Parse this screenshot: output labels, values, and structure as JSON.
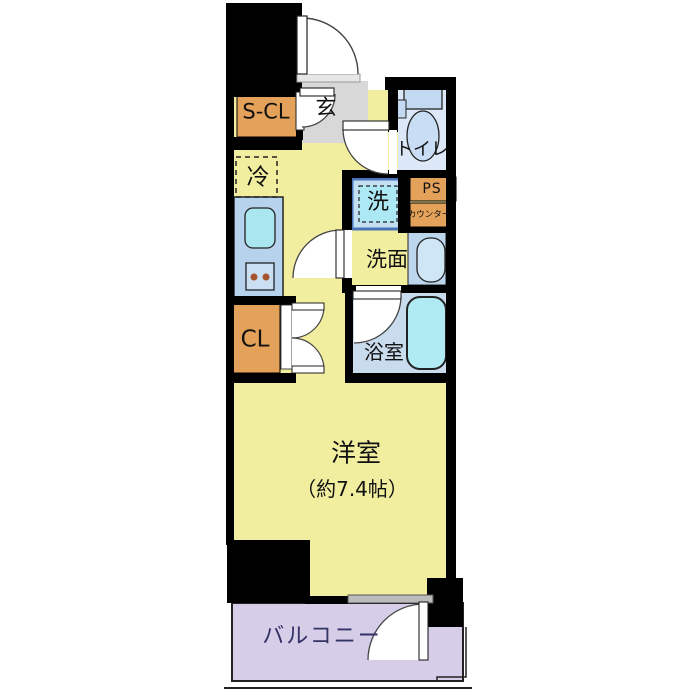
{
  "plan": {
    "storage_closet": {
      "label": "S-CL"
    },
    "entrance": {
      "label": "玄"
    },
    "toilet": {
      "label": "トイレ"
    },
    "refrigerator": {
      "label": "冷"
    },
    "washer": {
      "label": "洗"
    },
    "pipe_space": {
      "label": "PS"
    },
    "counter": {
      "label": "カウンター"
    },
    "washroom": {
      "label": "洗面"
    },
    "closet": {
      "label": "CL"
    },
    "bathroom": {
      "label": "浴室"
    },
    "western_room": {
      "label": "洋室",
      "size_label": "（約7.4帖）"
    },
    "balcony": {
      "label": "バルコニー"
    },
    "colors": {
      "wall": "#000000",
      "room_yellow": "#F1EEA0",
      "accent_orange": "#E4A159",
      "entrance_gray": "#D8D8D8",
      "toilet_blue": "#DCE8F8",
      "bath_blue": "#C9DCEE",
      "counter_blue": "#B7D2EC",
      "fixture_cyan": "#B0EAF2",
      "balcony_lavender": "#D6CDE8",
      "balcony_text_navy": "#333366"
    }
  }
}
